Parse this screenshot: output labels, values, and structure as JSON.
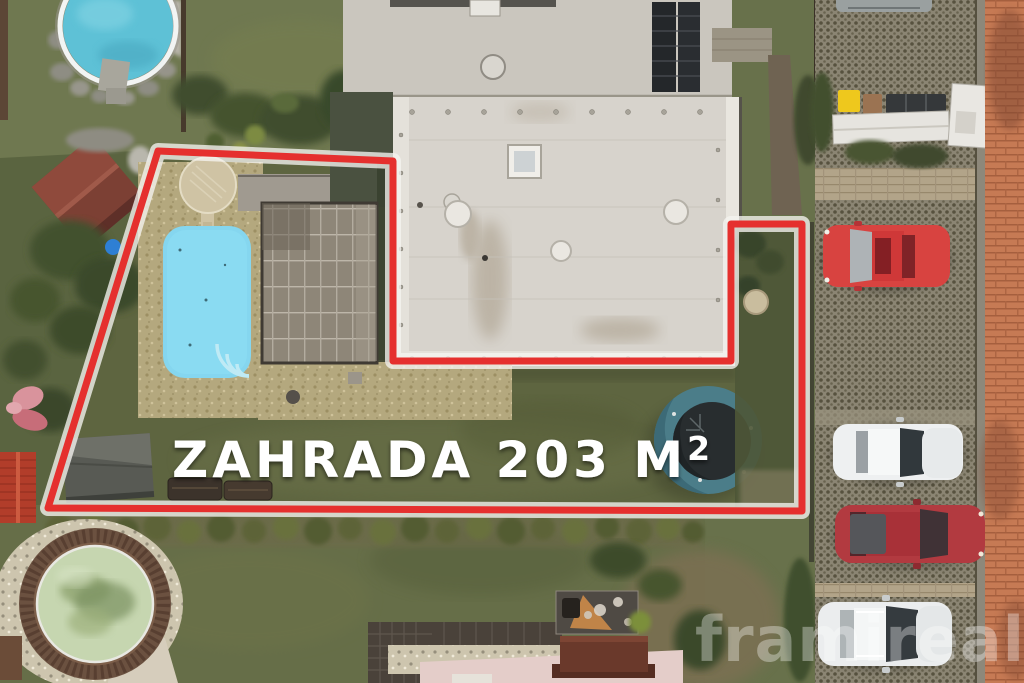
{
  "overlay": {
    "area_label": "ZAHRADA 203 M²",
    "area_label_main": "ZAHRADA 203 M",
    "area_label_sup": "2",
    "label_color": "#ffffff",
    "boundary_color": "#e5302e",
    "boundary_casing_color": "#f5f3ef"
  },
  "watermark": {
    "text": "framireal",
    "color": "#ffffff"
  },
  "scene": {
    "garden_pool_color": "#85d6ef",
    "trampoline_ring_color": "#4b7d89",
    "trampoline_mat_color": "#282d2f",
    "neighbor_pool_top_color": "#5ec1d6",
    "neighbor_pool_bottom_color": "#c6d6b0",
    "roof_color": "#d7d3cc",
    "brick_sidewalk_color": "#c67a54",
    "cars": [
      {
        "name": "red-hatchback",
        "color": "#d84340"
      },
      {
        "name": "white-suv-upper",
        "color": "#eef0f1"
      },
      {
        "name": "red-sedan",
        "color": "#b23a40"
      },
      {
        "name": "white-suv-lower",
        "color": "#ebedee"
      }
    ],
    "bins": {
      "yellow": "#eec81d",
      "brown": "#9b7352",
      "dark": "#35383a"
    }
  }
}
